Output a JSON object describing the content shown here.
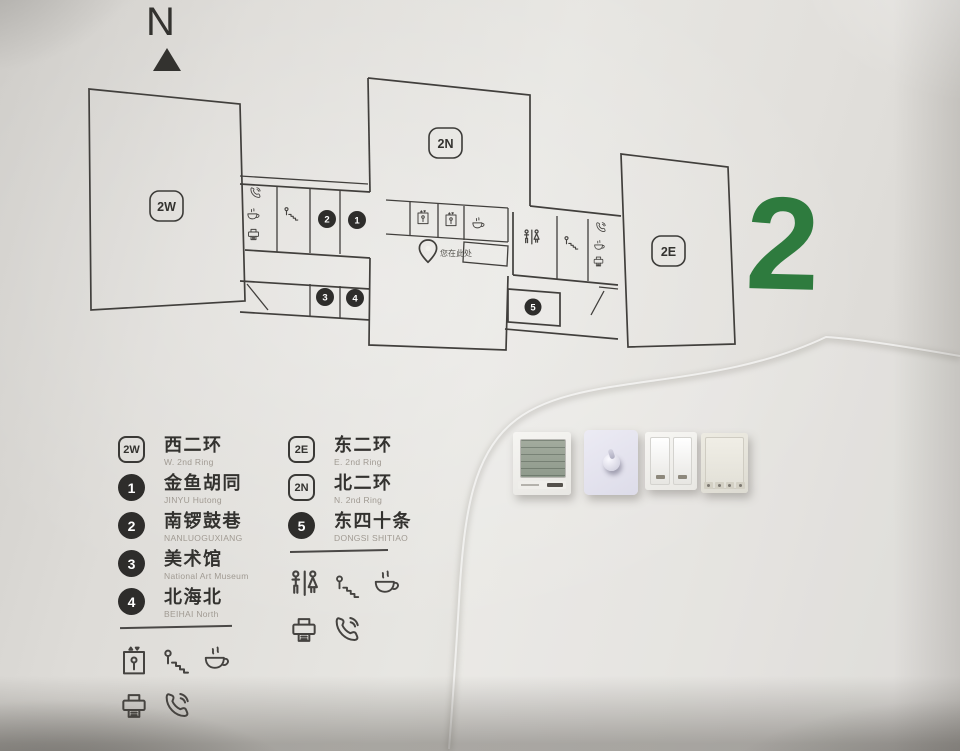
{
  "compass": {
    "label": "N"
  },
  "floor": {
    "number": "2",
    "accent_color": "#2e7b3e"
  },
  "map": {
    "badge_west": "2W",
    "badge_north": "2N",
    "badge_east": "2E",
    "stops": [
      "1",
      "2",
      "3",
      "4",
      "5"
    ],
    "you_are_here": "您在此处"
  },
  "legend": {
    "left": [
      {
        "marker": "2W",
        "type": "badge",
        "label": "西二环",
        "sub": "W. 2nd Ring"
      },
      {
        "marker": "1",
        "type": "dot",
        "label": "金鱼胡同",
        "sub": "JINYU Hutong"
      },
      {
        "marker": "2",
        "type": "dot",
        "label": "南锣鼓巷",
        "sub": "NANLUOGUXIANG"
      },
      {
        "marker": "3",
        "type": "dot",
        "label": "美术馆",
        "sub": "National Art Museum"
      },
      {
        "marker": "4",
        "type": "dot",
        "label": "北海北",
        "sub": "BEIHAI North"
      }
    ],
    "right": [
      {
        "marker": "2E",
        "type": "badge",
        "label": "东二环",
        "sub": "E. 2nd Ring"
      },
      {
        "marker": "2N",
        "type": "badge",
        "label": "北二环",
        "sub": "N. 2nd Ring"
      },
      {
        "marker": "5",
        "type": "dot",
        "label": "东四十条",
        "sub": "DONGSI SHITIAO"
      }
    ],
    "facility_icons_left": [
      "elevator",
      "stairs",
      "cafe",
      "printer",
      "phone"
    ],
    "facility_icons_right": [
      "toilets",
      "stairs",
      "cafe",
      "printer",
      "phone"
    ]
  },
  "wall_devices": [
    "thermostat",
    "dimmer-switch",
    "double-rocker-switch",
    "control-panel"
  ],
  "colors": {
    "wall": "#e2e0dc",
    "line": "#413f3c",
    "marker": "#2e2d2b",
    "green": "#2e7b3e"
  }
}
